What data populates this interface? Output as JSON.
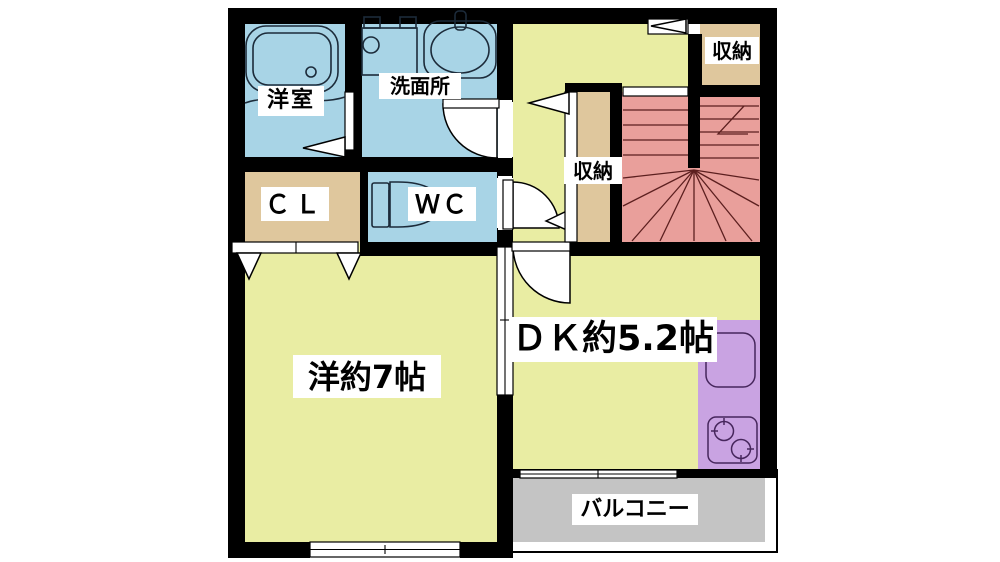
{
  "floorplan": {
    "rooms": {
      "bathroom": {
        "label": "洋室"
      },
      "washroom": {
        "label": "洗面所"
      },
      "storage_top": {
        "label": "収納"
      },
      "storage_hall": {
        "label": "収納"
      },
      "closet": {
        "label": "ＣＬ"
      },
      "toilet": {
        "label": "ＷＣ"
      },
      "western_room": {
        "label": "洋約7帖"
      },
      "dining_kitchen": {
        "label": "ＤＫ約5.2帖"
      },
      "balcony": {
        "label": "バルコニー"
      }
    },
    "colors": {
      "wet_area_blue": "#a8d4e6",
      "room_yellow": "#e9eda3",
      "storage_tan": "#dfc79d",
      "stairs_pink": "#e99f9b",
      "kitchen_purple": "#c9a3e2",
      "balcony_gray": "#c4c4c4",
      "wall_black": "#000000"
    }
  }
}
